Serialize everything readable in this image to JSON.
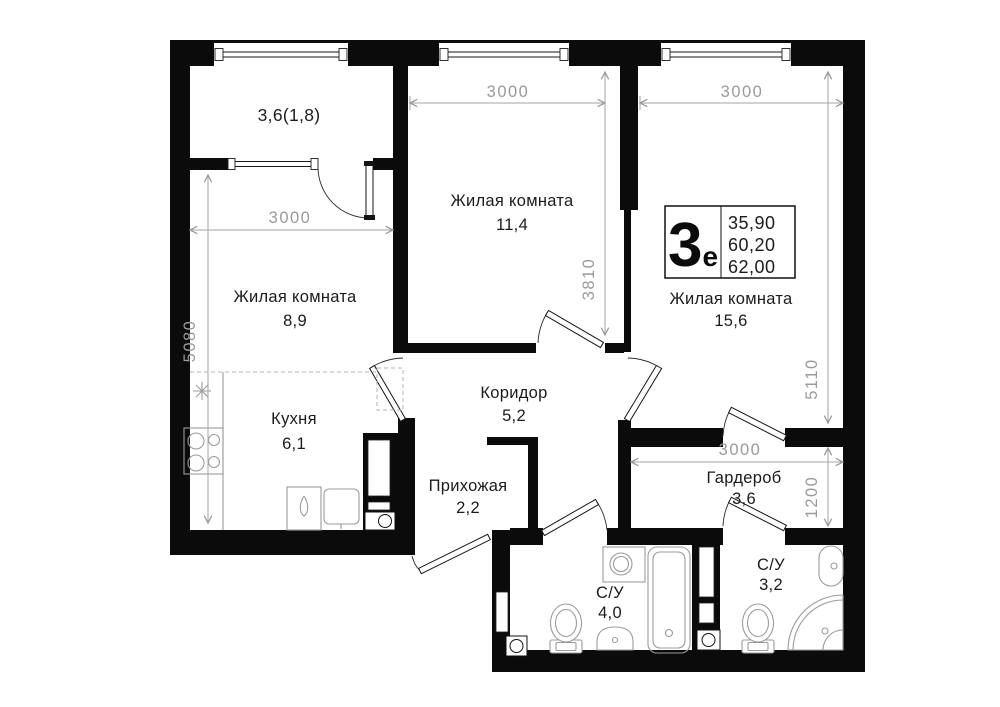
{
  "legend": {
    "type_number": "3",
    "type_suffix": "е",
    "area_values": [
      "35,90",
      "60,20",
      "62,00"
    ]
  },
  "rooms": {
    "balcony": {
      "area": "3,6(1,8)"
    },
    "living_top": {
      "name": "Жилая комната",
      "area": "11,4"
    },
    "living_left": {
      "name": "Жилая комната",
      "area": "8,9"
    },
    "living_right": {
      "name": "Жилая комната",
      "area": "15,6"
    },
    "kitchen": {
      "name": "Кухня",
      "area": "6,1"
    },
    "corridor": {
      "name": "Коридор",
      "area": "5,2"
    },
    "hallway": {
      "name": "Прихожая",
      "area": "2,2"
    },
    "wardrobe": {
      "name": "Гардероб",
      "area": "3,6"
    },
    "bath_left": {
      "name": "С/У",
      "area": "4,0"
    },
    "bath_right": {
      "name": "С/У",
      "area": "3,2"
    }
  },
  "dimensions": {
    "living_top_width": "3000",
    "living_right_width": "3000",
    "living_top_height": "3810",
    "living_right_height": "5110",
    "living_left_width": "3000",
    "living_left_height": "5080",
    "wardrobe_width": "3000",
    "wardrobe_height": "1200"
  }
}
